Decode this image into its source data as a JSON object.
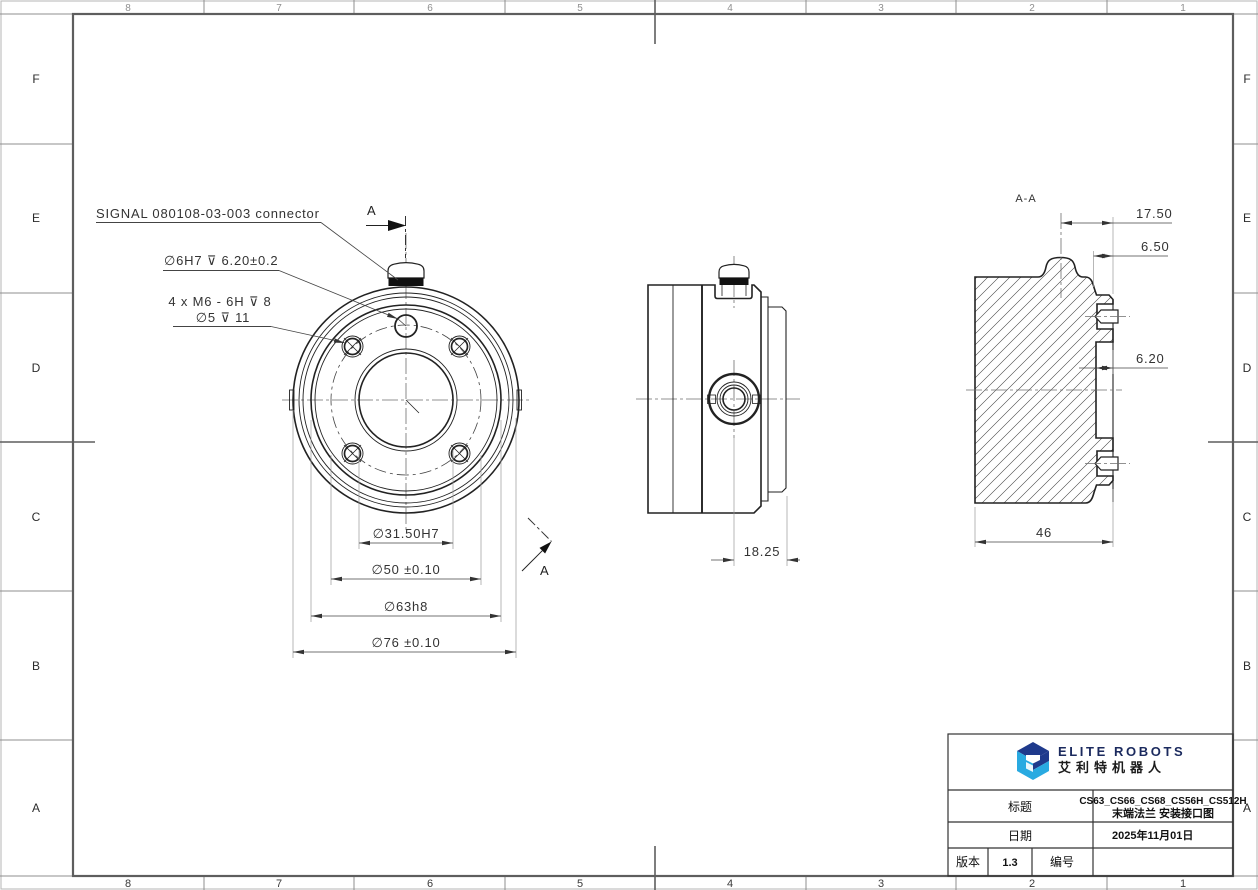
{
  "colors": {
    "object_line": "#222222",
    "frame_line": "#5e5e5e",
    "dim_line": "#4a4a4a",
    "ext_line": "#8a8a8a",
    "logo_dark_blue": "#1f3a8c",
    "logo_light_blue": "#29aae1"
  },
  "frame": {
    "cols": [
      "8",
      "7",
      "6",
      "5",
      "4",
      "3",
      "2",
      "1"
    ],
    "rows": [
      "F",
      "E",
      "D",
      "C",
      "B",
      "A"
    ]
  },
  "front_view": {
    "note_connector": "SIGNAL 080108-03-003 connector",
    "note_dowel": "∅6H7 ⊽ 6.20±0.2",
    "note_m6_line1": "4 x M6 - 6H ⊽ 8",
    "note_m6_line2": "∅5 ⊽ 11",
    "dim_bore": "∅31.50H7",
    "dim_bolt_circle": "∅50 ±0.10",
    "dim_pilot": "∅63h8",
    "dim_outer": "∅76 ±0.10",
    "cut_label_top": "A",
    "cut_label_bottom": "A"
  },
  "side_view": {
    "dim_offset": "18.25"
  },
  "section_view": {
    "label": "A-A",
    "dim_1": "17.50",
    "dim_2": "6.50",
    "dim_3": "6.20",
    "dim_4": "46"
  },
  "title_block": {
    "brand": "ELITE ROBOTS",
    "brand_cn": "艾利特机器人",
    "title_label": "标题",
    "title_value_line1": "CS63_CS66_CS68_CS56H_CS512H",
    "title_value_line2": "末端法兰 安装接口图",
    "date_label": "日期",
    "date_value": "2025年11月01日",
    "version_label": "版本",
    "version_value": "1.3",
    "number_label": "编号",
    "number_value": ""
  }
}
